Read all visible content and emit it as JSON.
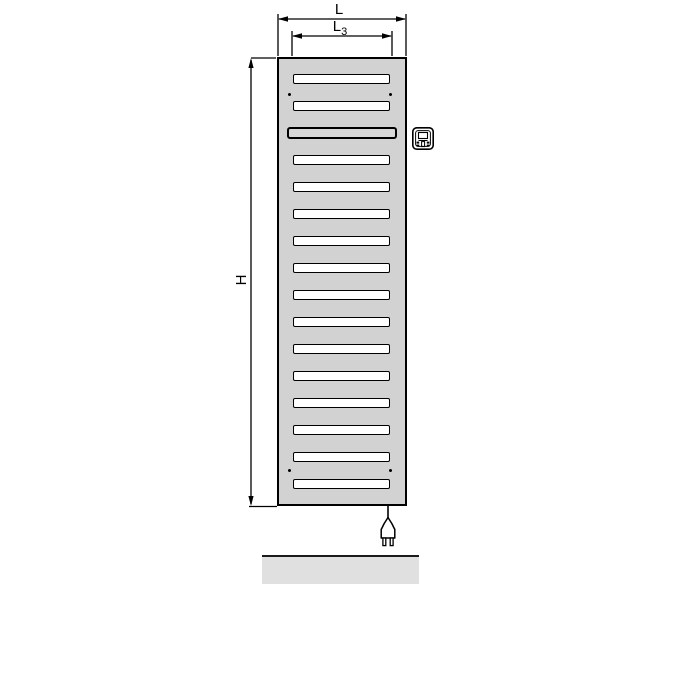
{
  "title": "Electric radiator dimension drawing",
  "labels": {
    "width": "L",
    "inner_width_base": "L",
    "inner_width_sub": "3",
    "height": "H"
  },
  "radiator": {
    "slats": {
      "count": 16,
      "special_index": 2
    },
    "screw_hole_count": 4,
    "colors": {
      "body": "#d2d2d2",
      "slat": "#ffffff",
      "special_slat": "#d8d8d8",
      "outline": "#000000"
    }
  },
  "icons": {
    "control_unit": "control-unit-icon",
    "power_plug": "power-plug-icon"
  },
  "floor": {
    "colors": {
      "fill": "#e0e0e0",
      "edge": "#1a1a1a"
    }
  }
}
